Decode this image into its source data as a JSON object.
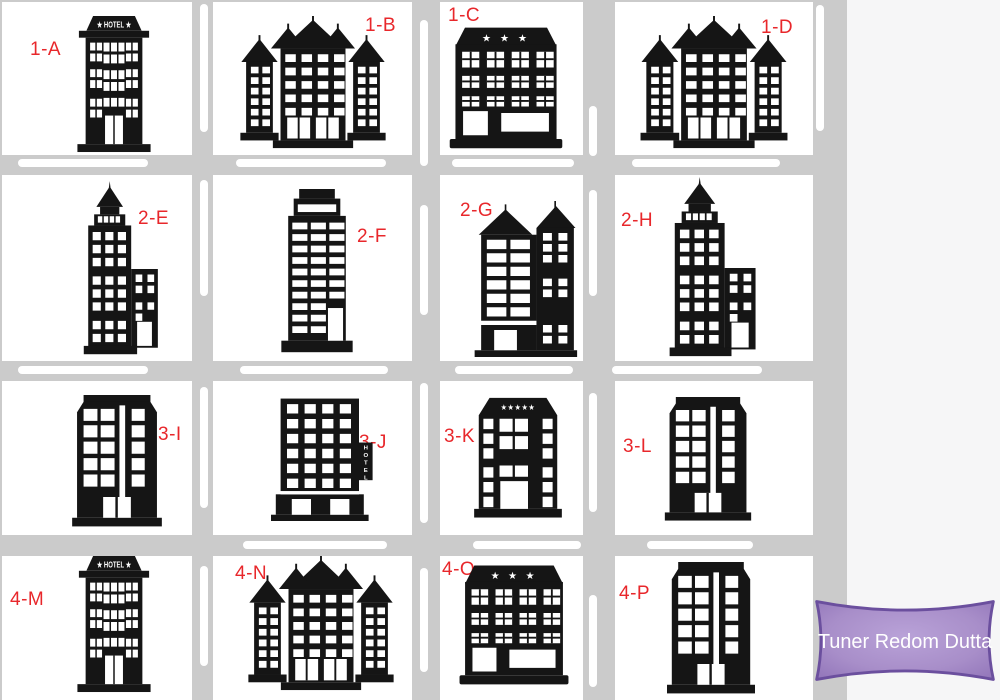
{
  "scene": {
    "description": "City block grid map with labeled hotel buildings",
    "colors": {
      "road": "#cbcbcb",
      "block": "#ffffff",
      "side_panel": "#f6f6f7",
      "building": "#151515",
      "label": "#e8272b",
      "badge_fill": "#a88ec9",
      "badge_border": "#6b4f9e",
      "badge_text_color": "#ffffff"
    }
  },
  "cells": [
    {
      "label": "1-A",
      "building": "hotel-banner-building"
    },
    {
      "label": "1-B",
      "building": "castle-hotel-building"
    },
    {
      "label": "1-C",
      "building": "three-star-hotel-building"
    },
    {
      "label": "1-D",
      "building": "castle-hotel-building"
    },
    {
      "label": "2-E",
      "building": "spire-skyscraper-building"
    },
    {
      "label": "2-F",
      "building": "office-tower-building"
    },
    {
      "label": "2-G",
      "building": "twin-tower-building"
    },
    {
      "label": "2-H",
      "building": "spire-skyscraper-building"
    },
    {
      "label": "3-I",
      "building": "stripe-tower-building"
    },
    {
      "label": "3-J",
      "building": "vertical-sign-hotel-building"
    },
    {
      "label": "3-K",
      "building": "five-star-hotel-building"
    },
    {
      "label": "3-L",
      "building": "stripe-tower-building"
    },
    {
      "label": "4-M",
      "building": "hotel-banner-building"
    },
    {
      "label": "4-N",
      "building": "castle-hotel-building"
    },
    {
      "label": "4-O",
      "building": "three-star-hotel-building"
    },
    {
      "label": "4-P",
      "building": "stripe-tower-building"
    }
  ],
  "signs": {
    "hotel_banner": "★ HOTEL ★",
    "three_stars": "★ ★ ★",
    "five_stars": "★★★★★",
    "vertical_hotel": [
      "H",
      "O",
      "T",
      "E",
      "L"
    ]
  },
  "badge": {
    "text": "Tuner Redom Dutta"
  }
}
